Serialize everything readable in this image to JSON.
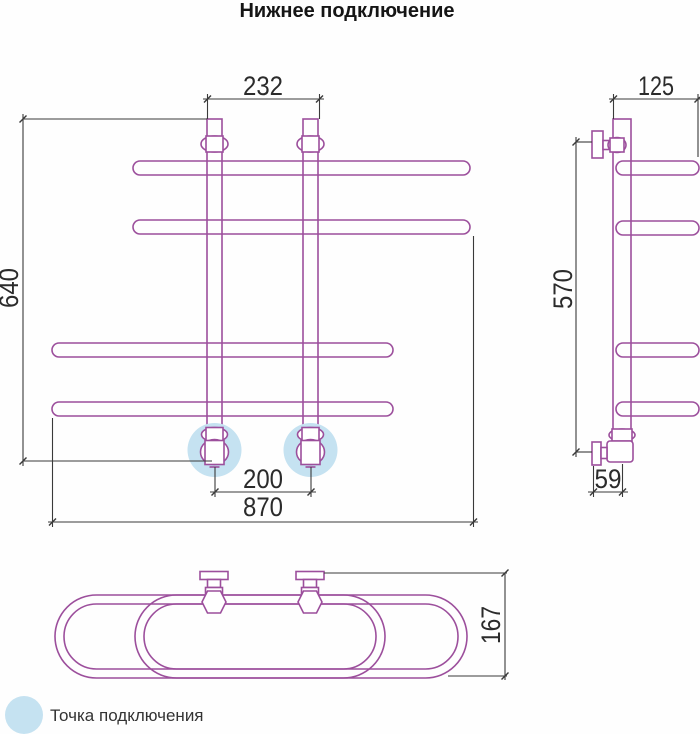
{
  "title": "Нижнее подключение",
  "dimensions": {
    "front_top_spacing": "232",
    "front_height": "640",
    "front_connection_spacing": "200",
    "front_total_width": "870",
    "side_depth": "125",
    "side_height": "570",
    "side_wall_offset": "59",
    "top_depth": "167"
  },
  "legend": {
    "label": "Точка подключения",
    "marker": "connection-point-marker"
  },
  "colors": {
    "pipe": "#9c4f9c",
    "dim": "#3a3a3a",
    "text": "#2b2b2b",
    "highlight": "#c5e2f1"
  }
}
